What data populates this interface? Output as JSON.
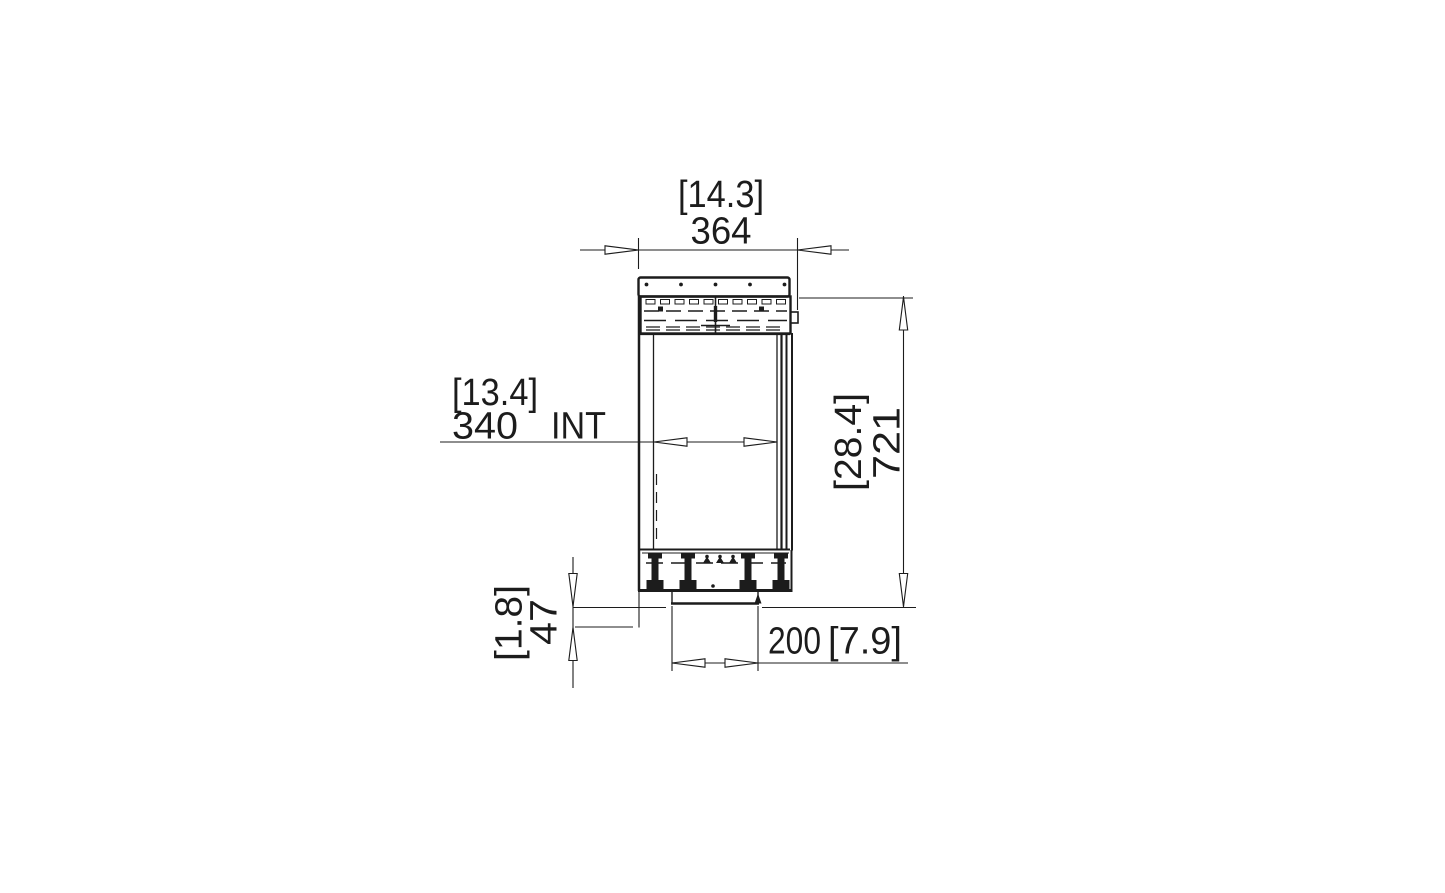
{
  "page": {
    "background": "#ffffff"
  },
  "drawing": {
    "kind": "technical-dimension-drawing",
    "view": "side-elevation",
    "line_color": "#1c1c1c",
    "dimensions": {
      "top_width": {
        "imperial_in": "[14.3]",
        "metric_mm": "364"
      },
      "internal_width": {
        "imperial_in": "[13.4]",
        "metric_mm": "340",
        "qualifier": "INT"
      },
      "overall_height": {
        "imperial_in": "[28.4]",
        "metric_mm": "721"
      },
      "base_offset": {
        "imperial_in": "[1.8]",
        "metric_mm": "47"
      },
      "bottom_width": {
        "metric_mm": "200",
        "imperial_in": "[7.9]"
      }
    }
  }
}
